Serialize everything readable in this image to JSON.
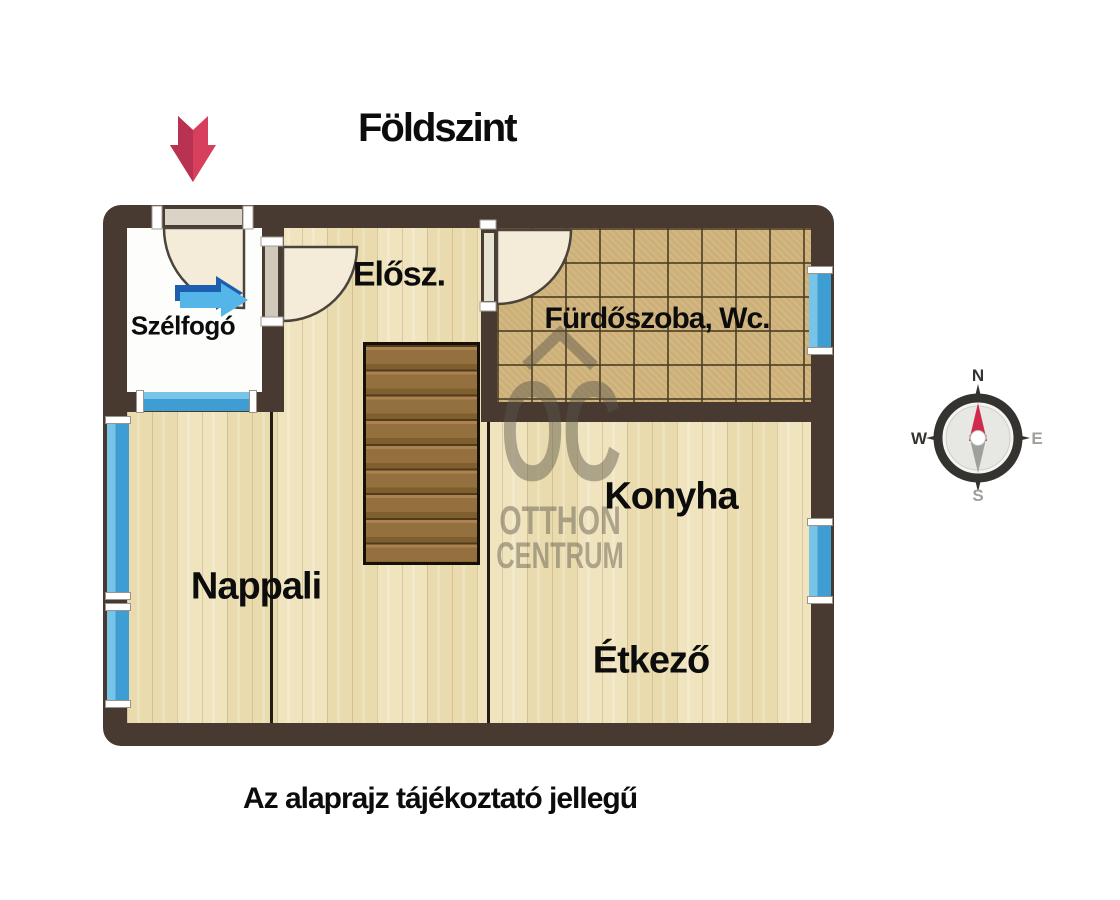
{
  "title": "Földszint",
  "disclaimer": "Az alaprajz tájékoztató jellegű",
  "rooms": {
    "szelfogo": "Szélfogó",
    "elosz": "Elősz.",
    "furdoszoba": "Fürdőszoba, Wc.",
    "konyha": "Konyha",
    "etkezo": "Étkező",
    "nappali": "Nappali"
  },
  "watermark": {
    "logo": "OC",
    "line1": "OTTHON",
    "line2": "CENTRUM"
  },
  "compass": {
    "n": "N",
    "e": "E",
    "s": "S",
    "w": "W"
  },
  "colors": {
    "wall": "#483a30",
    "window_blue": "#45a4d7",
    "wood_floor": "#ecdfb5",
    "tile_floor": "#cdb077",
    "white_floor": "#fdfdfc",
    "entry_arrow_red": "#d7405c",
    "interior_arrow_blue": "#1d5fae",
    "door_swing_fill": "#f4ecd9",
    "watermark_gray": "#5b5549"
  }
}
